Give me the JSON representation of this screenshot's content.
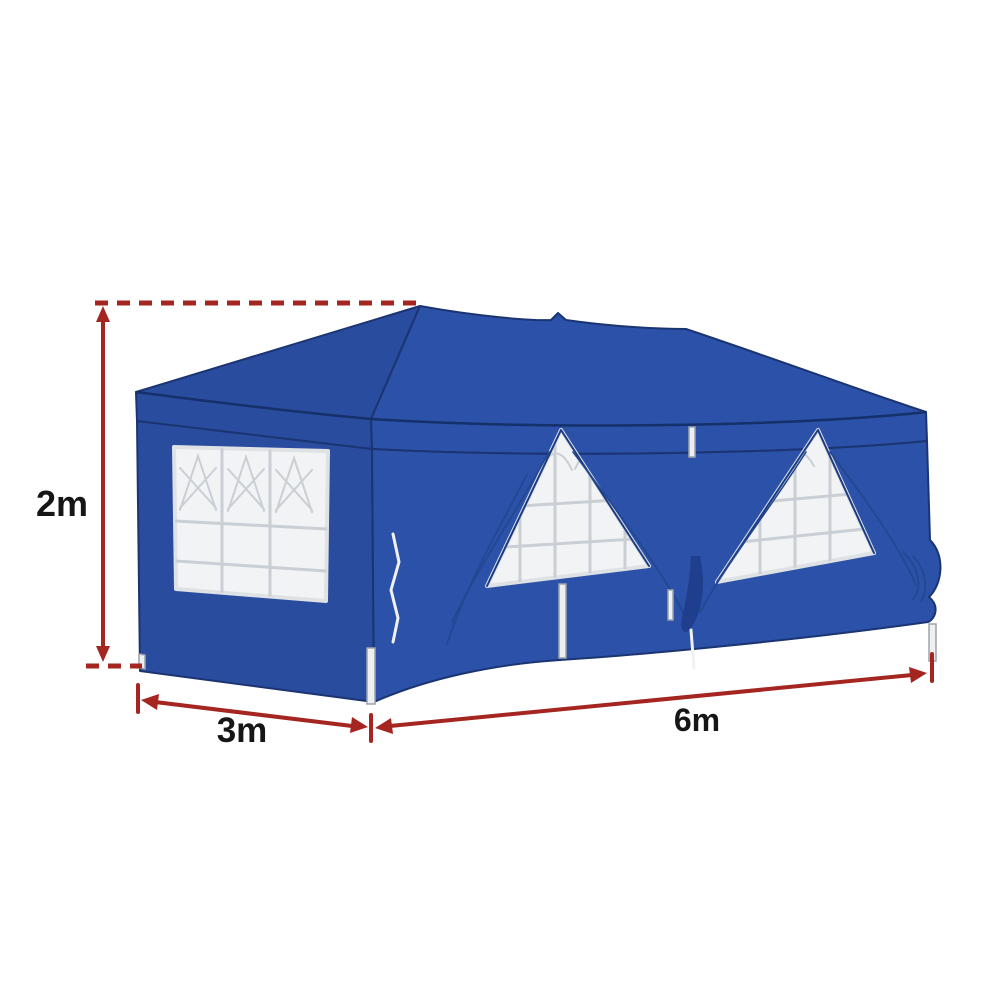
{
  "image": {
    "background": "#FFFFFF",
    "alt": "Blue pop-up gazebo marquee tent with white lattice windows and red dimension arrows",
    "colors": {
      "tent_blue": "#2B52A8",
      "tent_blue_shade": "#2A4C9F",
      "tent_blue_deep": "#1F3F8E",
      "tent_outline": "#1B3472",
      "window_white": "#F2F3F4",
      "window_grid": "#C9CFD4",
      "leg_white": "#EEEFF0",
      "dimension_red": "#A52521",
      "label_color": "#161616"
    },
    "dimensions": {
      "height_label": "2m",
      "width_label": "3m",
      "length_label": "6m"
    }
  }
}
